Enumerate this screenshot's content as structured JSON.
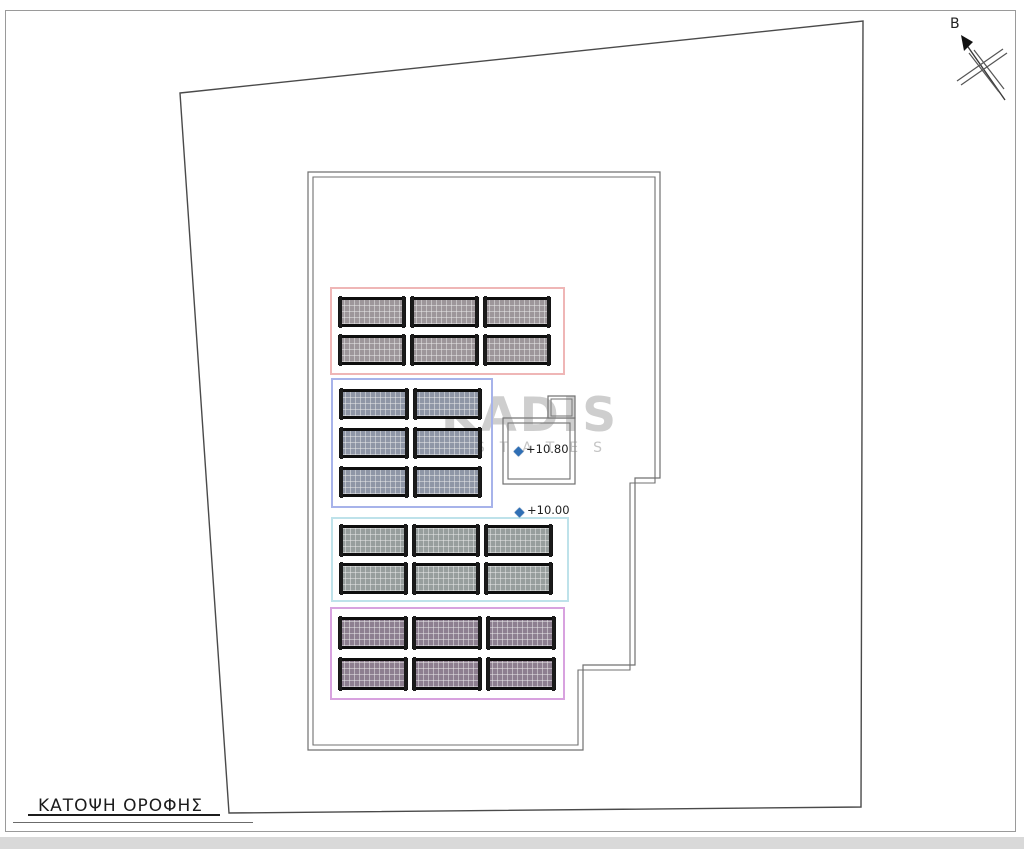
{
  "drawing": {
    "title": "ΚΑΤΟΨΗ ΟΡΟΦΗΣ"
  },
  "north_arrow": {
    "label": "B"
  },
  "watermark": {
    "line1": "KADIS",
    "line2": "ESTATES"
  },
  "elevation_markers": [
    {
      "label": "+10.80"
    },
    {
      "label": "+10.00"
    }
  ],
  "panel_groups": [
    {
      "name": "panel-group-top",
      "outline_color": "#efb6b6",
      "panel_color": "#9d969a",
      "rows": 2,
      "cols": 3
    },
    {
      "name": "panel-group-upper-middle",
      "outline_color": "#a7b3ea",
      "panel_color": "#8f96a6",
      "rows": 3,
      "cols": 2
    },
    {
      "name": "panel-group-lower-middle",
      "outline_color": "#bee2ea",
      "panel_color": "#979e9d",
      "rows": 2,
      "cols": 3
    },
    {
      "name": "panel-group-bottom",
      "outline_color": "#d8a2df",
      "panel_color": "#8d7f90",
      "rows": 2,
      "cols": 3
    }
  ],
  "colors": {
    "marker_blue": "#2f6fb5",
    "plot_line": "#4a4a4a",
    "building_line": "#707070",
    "watermark_gray": "#9a9a9a"
  }
}
